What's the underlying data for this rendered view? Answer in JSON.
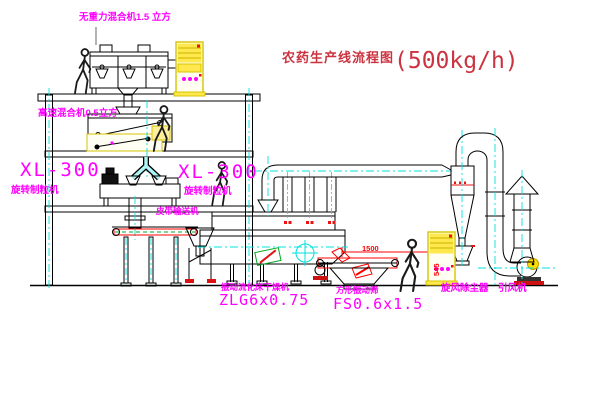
{
  "title": {
    "name": "农药生产线流程图",
    "capacity": "(500kg/h)"
  },
  "labels": {
    "gravity_mixer": "无重力混合机1.5 立方",
    "high_speed_mixer": "高速混合机0.5立方",
    "granulator_left_model": "XL-300",
    "granulator_left_name": "旋转制粒机",
    "granulator_right_model": "XL-300",
    "granulator_right_name": "旋转制粒机",
    "belt_conveyor": "皮带输送机",
    "fluid_bed_dryer_name": "振动流化床干燥机",
    "fluid_bed_dryer_model": "ZLG6x0.75",
    "square_sieve_name": "方形振动筛",
    "square_sieve_model": "FS0.6x1.5",
    "cyclone_dust_collector": "旋风除尘器",
    "induced_draft_fan": "引风机"
  },
  "dimensions": {
    "sieve_length_mm": "1500",
    "sieve_height_mm": "545"
  },
  "colors": {
    "label_magenta": "#ff00ff",
    "title_red": "#cc3340",
    "line_red": "#ff0000",
    "centerline_cyan": "#00e0e0",
    "equipment_yellow": "#ffe84d",
    "green_accent": "#00aa22",
    "line_black": "#000000"
  }
}
